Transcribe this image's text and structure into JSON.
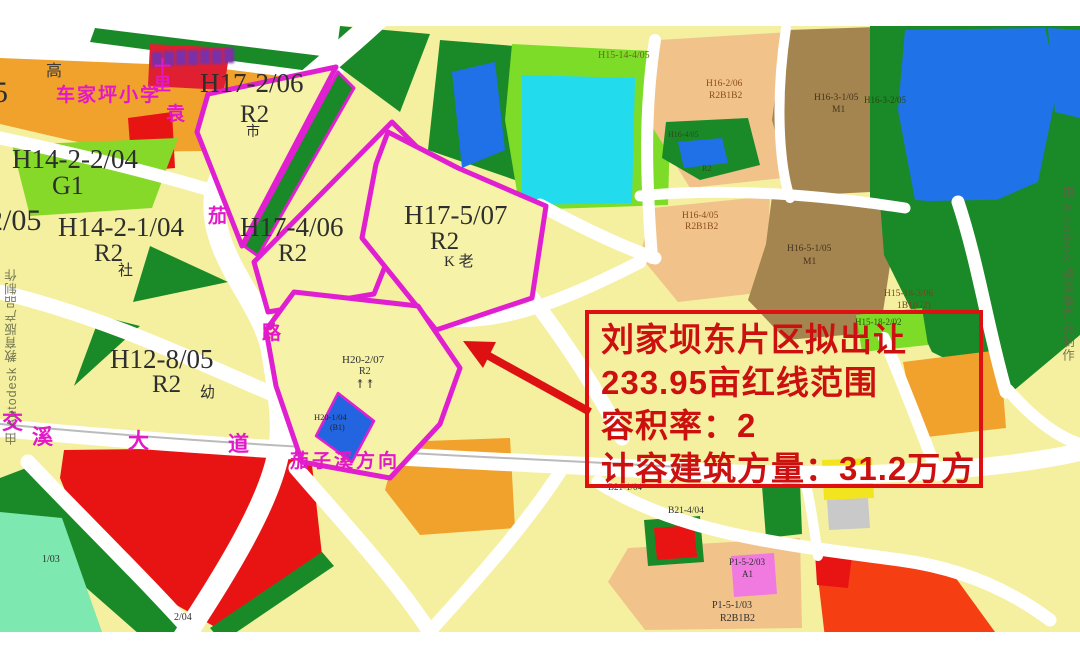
{
  "annotation": {
    "lines": [
      "刘家坝东片区拟出让",
      "233.95亩红线范围",
      "容积率：2",
      "计容建筑方量：31.2万方"
    ],
    "border_color": "#dd1111",
    "text_color": "#cc1010"
  },
  "parcels": {
    "h17_2": {
      "id": "H17-2/06",
      "zone": "R2",
      "mark": "市"
    },
    "h17_4": {
      "id": "H17-4/06",
      "zone": "R2"
    },
    "h17_5": {
      "id": "H17-5/07",
      "zone": "R2",
      "mark": "K 老"
    },
    "h20_2": {
      "id": "H20-2/07",
      "zone": "R2",
      "icons": "↟↟"
    },
    "h20_1": {
      "id": "H20-1/04",
      "zone": "(B1)"
    },
    "h14_2_2": {
      "id": "H14-2-2/04",
      "zone": "G1"
    },
    "h14_2_1": {
      "id": "H14-2-1/04",
      "zone": "R2",
      "mark": "社"
    },
    "h12_8": {
      "id": "H12-8/05",
      "zone": "R2",
      "mark": "幼"
    },
    "h15_14_4": {
      "id": "H15-14-4/05"
    },
    "h16_2": {
      "id": "H16-2/06",
      "zone": "R2B1B2"
    },
    "h16_small": {
      "id": "H16-4/05",
      "zone": "R2"
    },
    "h16_3_1": {
      "id": "H16-3-1/05",
      "zone": "M1"
    },
    "h16_3_2": {
      "id": "H16-3-2/05"
    },
    "h16_4": {
      "id": "H16-4/05",
      "zone": "R2B1B2"
    },
    "h16_5_1": {
      "id": "H16-5-1/05",
      "zone": "M1"
    },
    "h15_18_3": {
      "id": "H15-18-3/06",
      "zone": "1B1(G2)"
    },
    "h15_18_2": {
      "id": "H15-18-2/02"
    },
    "b21_1": {
      "id": "B21-1/04"
    },
    "b21_4": {
      "id": "B21-4/04"
    },
    "p1_5_2": {
      "id": "P1-5-2/03",
      "zone": "A1"
    },
    "p1_5_1": {
      "id": "P1-5-1/03",
      "zone": "R2B1B2"
    },
    "edge_5": {
      "id": "5"
    },
    "edge_2_05": {
      "id": "2/05"
    },
    "edge_1_03": {
      "id": "1/03"
    },
    "edge_2_04": {
      "id": "2/04"
    }
  },
  "streets": {
    "yuanjia_road": [
      "袁",
      "茄",
      "路"
    ],
    "shili": "十里",
    "jiaoxi_avenue": [
      "交",
      "溪",
      "大",
      "道"
    ],
    "qiezixi_direction": "茄子溪方向",
    "school": "车家坪小学",
    "gao": "高"
  },
  "credits": {
    "autodesk": "由 Autodesk 教育版产品制作"
  },
  "colors": {
    "redline": "#e020d0",
    "annotation_red": "#dd1111",
    "road_white": "#ffffff",
    "base_yellow": "#f5f0a0",
    "green": "#1a8a28",
    "lime": "#7cdc28",
    "mint": "#7de8b0",
    "cyan": "#22dcee",
    "blue": "#2070e8",
    "orange": "#f0a22c",
    "peach": "#f1c38a",
    "brown": "#a5854f",
    "red": "#e81414",
    "orange_red": "#f53e12",
    "pink": "#f07ae0"
  }
}
